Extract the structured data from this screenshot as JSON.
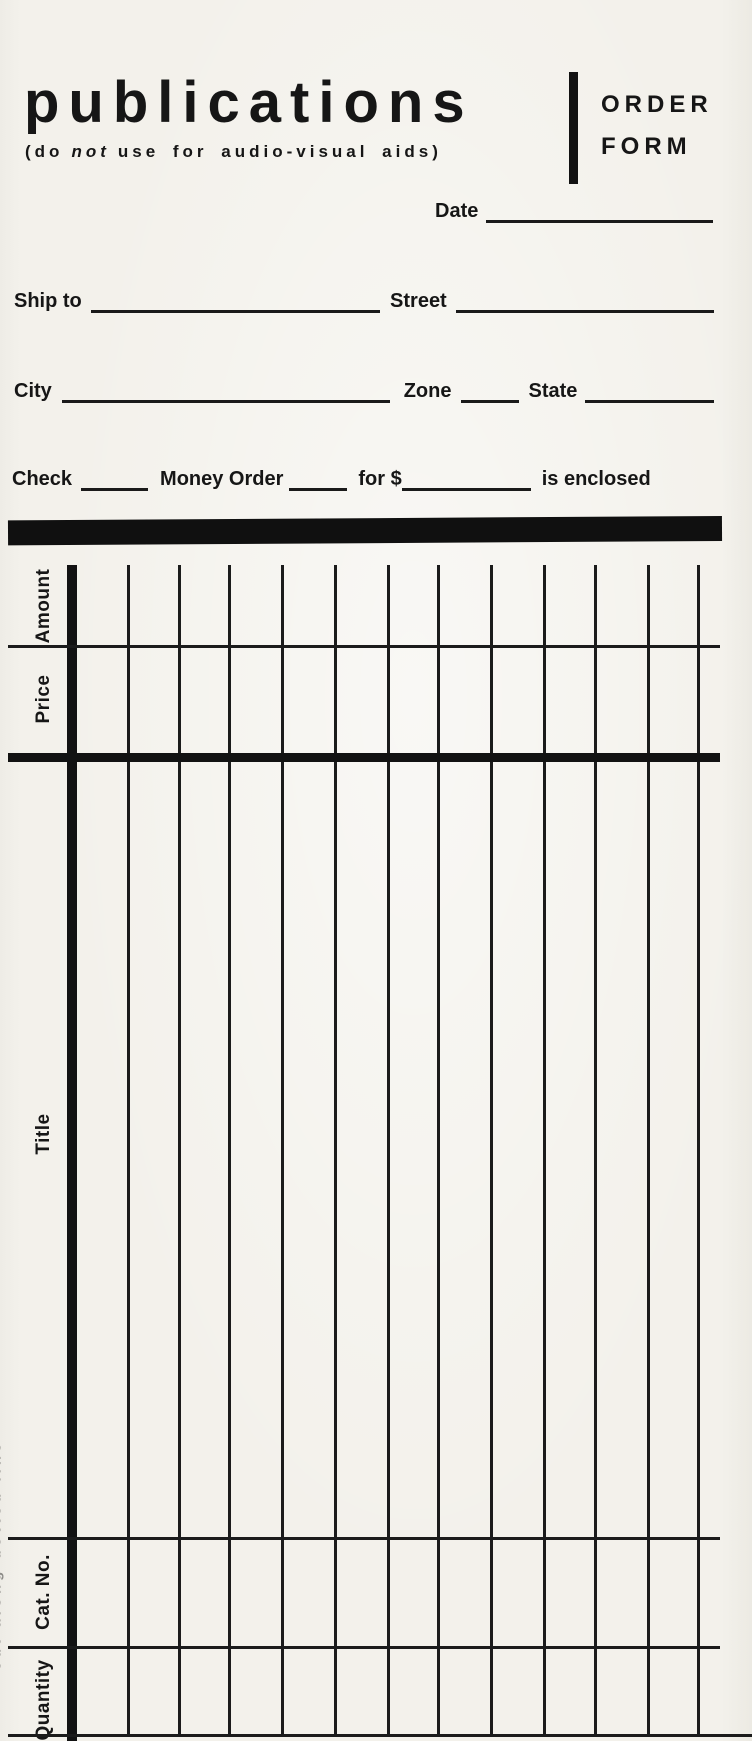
{
  "colors": {
    "paper": "#f2f0ea",
    "ink": "#161616"
  },
  "header": {
    "title": "publications",
    "subtitle_pre": "(do",
    "subtitle_em": "not",
    "subtitle_post": "use for audio-visual aids)",
    "order_word": "ORDER",
    "form_word": "FORM"
  },
  "fields": {
    "date": "Date",
    "ship_to": "Ship to",
    "street": "Street",
    "city": "City",
    "zone": "Zone",
    "state": "State",
    "check": "Check",
    "money_order": "Money Order",
    "for_amount": "for $",
    "is_enclosed": "is enclosed"
  },
  "table": {
    "headers": [
      "Amount",
      "Price",
      "Title",
      "Cat. No.",
      "Quantity"
    ]
  },
  "edge_note": "cut along dotted line"
}
